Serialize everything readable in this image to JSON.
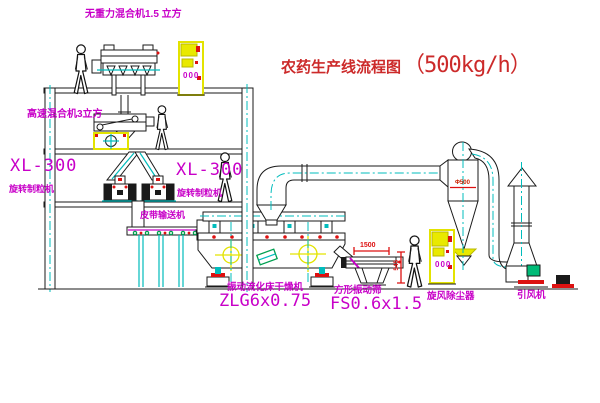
{
  "title": {
    "main": "农药生产线流程图",
    "capacity": "（500kg/h）"
  },
  "equipment_labels": {
    "top_mixer": "无重力混合机1.5 立方",
    "highspeed_mixer": "高速混合机3立方",
    "granulator_left_model": "XL-300",
    "granulator_left_name": "旋转制粒机",
    "granulator_right_model": "XL-300",
    "granulator_right_name": "旋转制粒机",
    "belt_conveyor": "皮带输送机",
    "dryer_name": "振动流化床干燥机",
    "dryer_model": "ZLG6x0.75",
    "screen_name": "方形振动筛",
    "screen_model": "FS0.6x1.5",
    "cyclone_name": "旋风除尘器",
    "fan_name": "引风机"
  },
  "dimensions": {
    "screen_length": "1500",
    "screen_height": "545",
    "cyclone_inlet": "Φ500"
  },
  "panel": {
    "display": "000"
  },
  "colors": {
    "label_magenta": "#c800c8",
    "title_red": "#cc2a2a",
    "line_black": "#1a1a1a",
    "centerline_cyan": "#00bcbc",
    "accent_yellow": "#e3e300",
    "accent_red": "#dd1111",
    "accent_green": "#00a050"
  }
}
